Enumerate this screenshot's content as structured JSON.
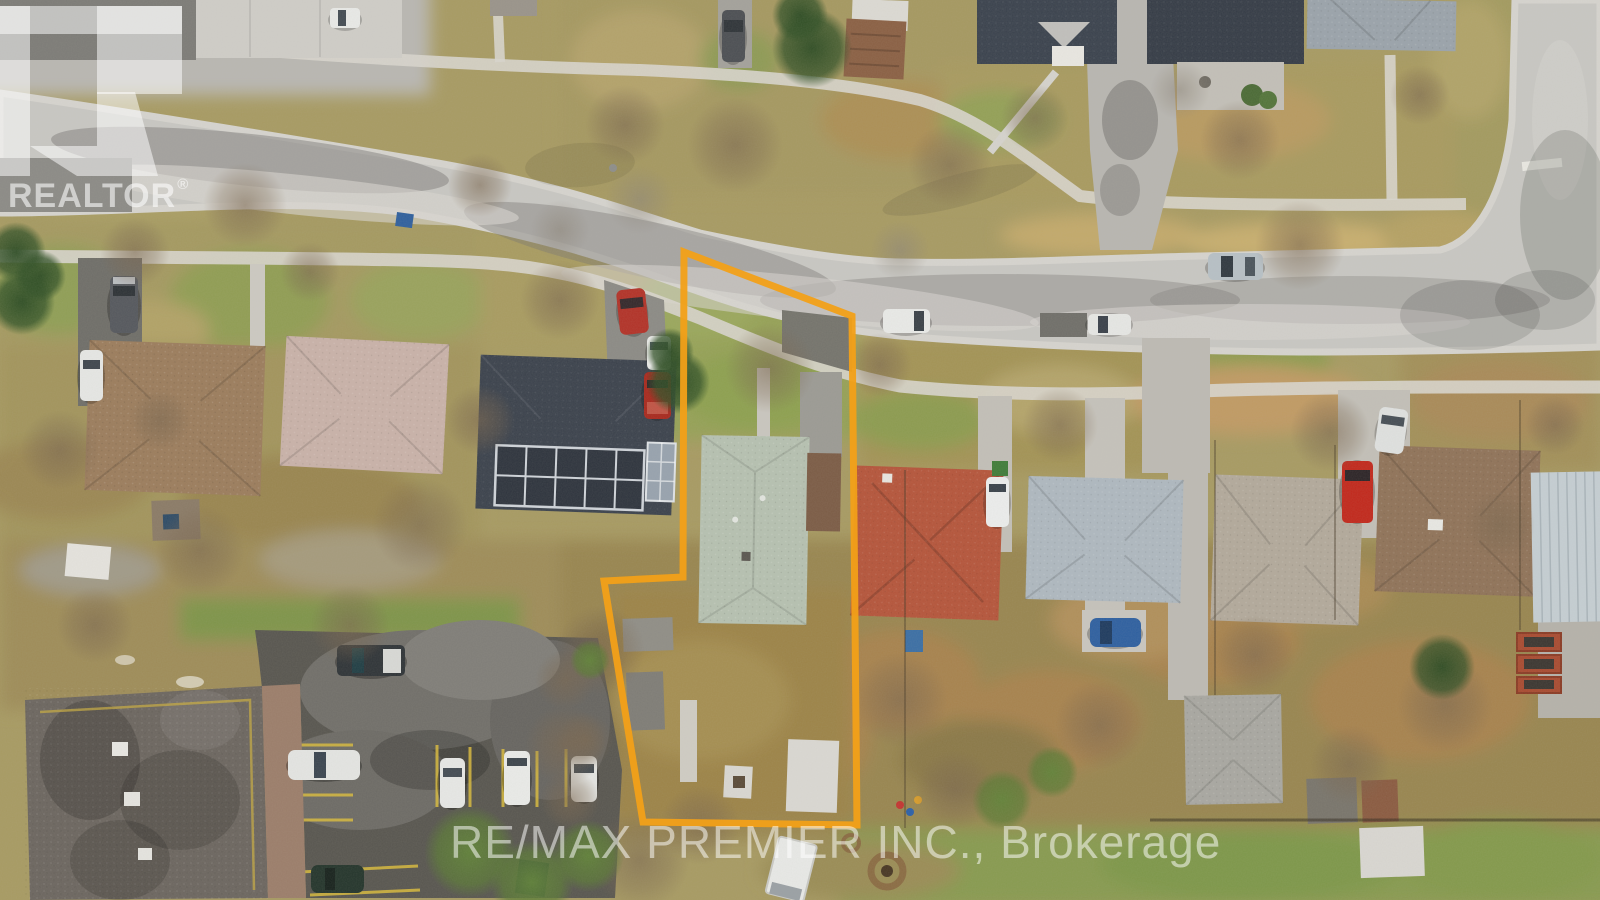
{
  "branding": {
    "realtor_logo": {
      "label": "REALTOR",
      "registered_mark": "®"
    },
    "brokerage_watermark": "RE/MAX PREMIER INC., Brokerage"
  },
  "property_outline": {
    "color": "#F2A018"
  },
  "watermark_color": "#FFFFFF"
}
